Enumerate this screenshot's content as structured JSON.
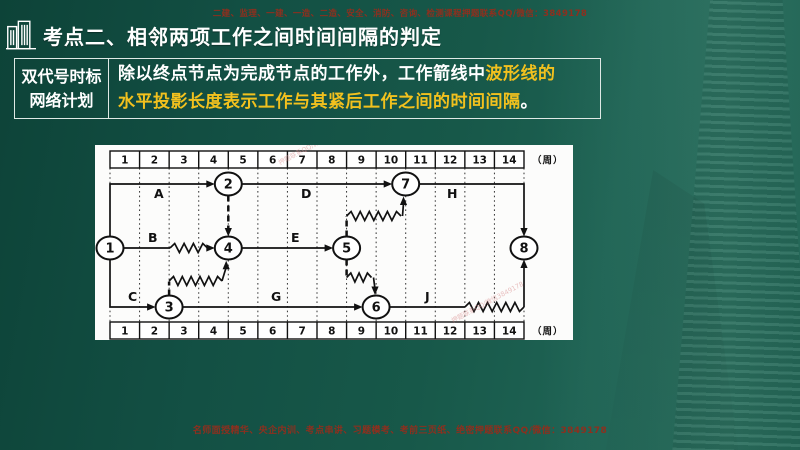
{
  "page": {
    "top_notice": "二建、监理、一建、一造、二造、安全、消防、咨询、检测课程押题联系QQ/微信：3849178",
    "footer_notice": "名师面授精华、央企内训、考点串讲、习题模考、考前三页纸、绝密押题联系QQ/微信：3849178"
  },
  "header": {
    "title": "考点二、相邻两项工作之间时间间隔的判定",
    "icon": "buildings-icon"
  },
  "info_table": {
    "term_line1": "双代号时标",
    "term_line2": "网络计划",
    "def_line1_white": "除以终点节点为完成节点的工作外，工作箭线中",
    "def_line1_yellow": "波形线的",
    "def_line2_yellow": "水平投影长度表示工作与其紧后工作之间的时间间隔",
    "def_line2_white": "。"
  },
  "colors": {
    "background_green": "#175849",
    "title_text": "#ffffff",
    "highlight_yellow": "#f2c11e",
    "notice_red": "#8e2f1e",
    "table_border": "#dfe9e5",
    "diagram_ink": "#111111",
    "panel_white": "#fcfcfb",
    "watermark_pink": "#d98c8c"
  },
  "diagram": {
    "unit_label": "（周）",
    "weeks": [
      1,
      2,
      3,
      4,
      5,
      6,
      7,
      8,
      9,
      10,
      11,
      12,
      13,
      14
    ],
    "watermark_text": "押题联系QQ/微信3849178",
    "geometry": {
      "x0": 15,
      "unit": 29.571,
      "row_h": 17,
      "scale_y": [
        6,
        177
      ]
    },
    "nodes": [
      {
        "id": "1",
        "x": 15,
        "y": 103
      },
      {
        "id": "2",
        "x": 133.3,
        "y": 39
      },
      {
        "id": "3",
        "x": 74.1,
        "y": 162
      },
      {
        "id": "4",
        "x": 133.3,
        "y": 103
      },
      {
        "id": "5",
        "x": 251.6,
        "y": 103
      },
      {
        "id": "6",
        "x": 281.1,
        "y": 162
      },
      {
        "id": "7",
        "x": 310.7,
        "y": 39
      },
      {
        "id": "8",
        "x": 429,
        "y": 103
      }
    ],
    "activity_labels": [
      {
        "text": "A",
        "x": 59,
        "y": 53
      },
      {
        "text": "B",
        "x": 53,
        "y": 97
      },
      {
        "text": "C",
        "x": 33,
        "y": 156
      },
      {
        "text": "D",
        "x": 206,
        "y": 53
      },
      {
        "text": "E",
        "x": 196,
        "y": 97
      },
      {
        "text": "G",
        "x": 176,
        "y": 156
      },
      {
        "text": "H",
        "x": 352,
        "y": 53
      },
      {
        "text": "J",
        "x": 330,
        "y": 156
      }
    ],
    "edges": [
      {
        "name": "A",
        "from": "1",
        "to": "2",
        "segments": [
          {
            "type": "solid",
            "pts": [
              [
                15,
                91.5
              ],
              [
                15,
                39
              ],
              [
                112,
                39
              ]
            ]
          }
        ],
        "arrow": {
          "x": 119.8,
          "y": 39,
          "dir": "right"
        }
      },
      {
        "name": "D",
        "from": "2",
        "to": "7",
        "segments": [
          {
            "type": "solid",
            "pts": [
              [
                146.8,
                39
              ],
              [
                289.5,
                39
              ]
            ]
          }
        ],
        "arrow": {
          "x": 297.2,
          "y": 39,
          "dir": "right"
        }
      },
      {
        "name": "H",
        "from": "7",
        "to": "8",
        "segments": [
          {
            "type": "solid",
            "pts": [
              [
                324.2,
                39
              ],
              [
                429,
                39
              ],
              [
                429,
                83.5
              ]
            ]
          }
        ],
        "arrow": {
          "x": 429,
          "y": 91.5,
          "dir": "down"
        }
      },
      {
        "name": "dummy-2-4",
        "from": "2",
        "to": "4",
        "segments": [
          {
            "type": "dashed",
            "pts": [
              [
                133.3,
                50.5
              ],
              [
                133.3,
                83.5
              ]
            ]
          }
        ],
        "arrow": {
          "x": 133.3,
          "y": 91.5,
          "dir": "down"
        }
      },
      {
        "name": "B",
        "from": "1",
        "to": "4",
        "segments": [
          {
            "type": "solid",
            "pts": [
              [
                28.5,
                103
              ],
              [
                75,
                103
              ]
            ]
          },
          {
            "type": "wave",
            "pts": [
              [
                75,
                103
              ],
              [
                112.5,
                103
              ]
            ]
          }
        ],
        "arrow": {
          "x": 119.8,
          "y": 103,
          "dir": "right"
        }
      },
      {
        "name": "E",
        "from": "4",
        "to": "5",
        "segments": [
          {
            "type": "solid",
            "pts": [
              [
                146.8,
                103
              ],
              [
                230.3,
                103
              ]
            ]
          }
        ],
        "arrow": {
          "x": 238.1,
          "y": 103,
          "dir": "right"
        }
      },
      {
        "name": "C",
        "from": "1",
        "to": "3",
        "segments": [
          {
            "type": "solid",
            "pts": [
              [
                15,
                114.5
              ],
              [
                15,
                162
              ],
              [
                52.8,
                162
              ]
            ]
          }
        ],
        "arrow": {
          "x": 60.6,
          "y": 162,
          "dir": "right"
        }
      },
      {
        "name": "G",
        "from": "3",
        "to": "6",
        "segments": [
          {
            "type": "solid",
            "pts": [
              [
                87.6,
                162
              ],
              [
                259.8,
                162
              ]
            ]
          }
        ],
        "arrow": {
          "x": 267.6,
          "y": 162,
          "dir": "right"
        }
      },
      {
        "name": "J",
        "from": "6",
        "to": "8",
        "segments": [
          {
            "type": "solid",
            "pts": [
              [
                294.6,
                162
              ],
              [
                369.9,
                162
              ]
            ]
          },
          {
            "type": "wave",
            "pts": [
              [
                369.9,
                162
              ],
              [
                429,
                162
              ]
            ]
          },
          {
            "type": "solid",
            "pts": [
              [
                429,
                162
              ],
              [
                429,
                122.5
              ]
            ]
          }
        ],
        "arrow": {
          "x": 429,
          "y": 114.5,
          "dir": "up"
        }
      },
      {
        "name": "link-3-4",
        "from": "3",
        "to": "4",
        "segments": [
          {
            "type": "dashed",
            "pts": [
              [
                74.1,
                150.5
              ],
              [
                74.1,
                136.5
              ]
            ]
          },
          {
            "type": "wave",
            "pts": [
              [
                74.1,
                136
              ],
              [
                127,
                136
              ]
            ]
          },
          {
            "type": "solid",
            "pts": [
              [
                127,
                136
              ],
              [
                130.8,
                123.5
              ]
            ]
          }
        ],
        "arrow": {
          "x": 131.2,
          "y": 115.8,
          "dir": "up"
        }
      },
      {
        "name": "link-5-7",
        "from": "5",
        "to": "7",
        "segments": [
          {
            "type": "dashed",
            "pts": [
              [
                251.6,
                91.5
              ],
              [
                251.6,
                71
              ]
            ]
          },
          {
            "type": "wave",
            "pts": [
              [
                251.6,
                71
              ],
              [
                306,
                71
              ]
            ]
          },
          {
            "type": "solid",
            "pts": [
              [
                307.5,
                71
              ],
              [
                308.4,
                59.5
              ]
            ]
          }
        ],
        "arrow": {
          "x": 308.5,
          "y": 51.5,
          "dir": "up"
        }
      },
      {
        "name": "link-5-6",
        "from": "5",
        "to": "6",
        "segments": [
          {
            "type": "dashed",
            "pts": [
              [
                251.6,
                114.5
              ],
              [
                251.6,
                130.5
              ]
            ]
          },
          {
            "type": "wave",
            "pts": [
              [
                251.6,
                132.5
              ],
              [
                276.5,
                132.5
              ]
            ]
          },
          {
            "type": "solid",
            "pts": [
              [
                278.5,
                132.5
              ],
              [
                279.8,
                142.5
              ]
            ]
          }
        ],
        "arrow": {
          "x": 280,
          "y": 150,
          "dir": "down"
        }
      }
    ],
    "watermarks": [
      {
        "x": 185,
        "y": 20,
        "angle": -28
      },
      {
        "x": 358,
        "y": 178,
        "angle": -28
      }
    ]
  }
}
